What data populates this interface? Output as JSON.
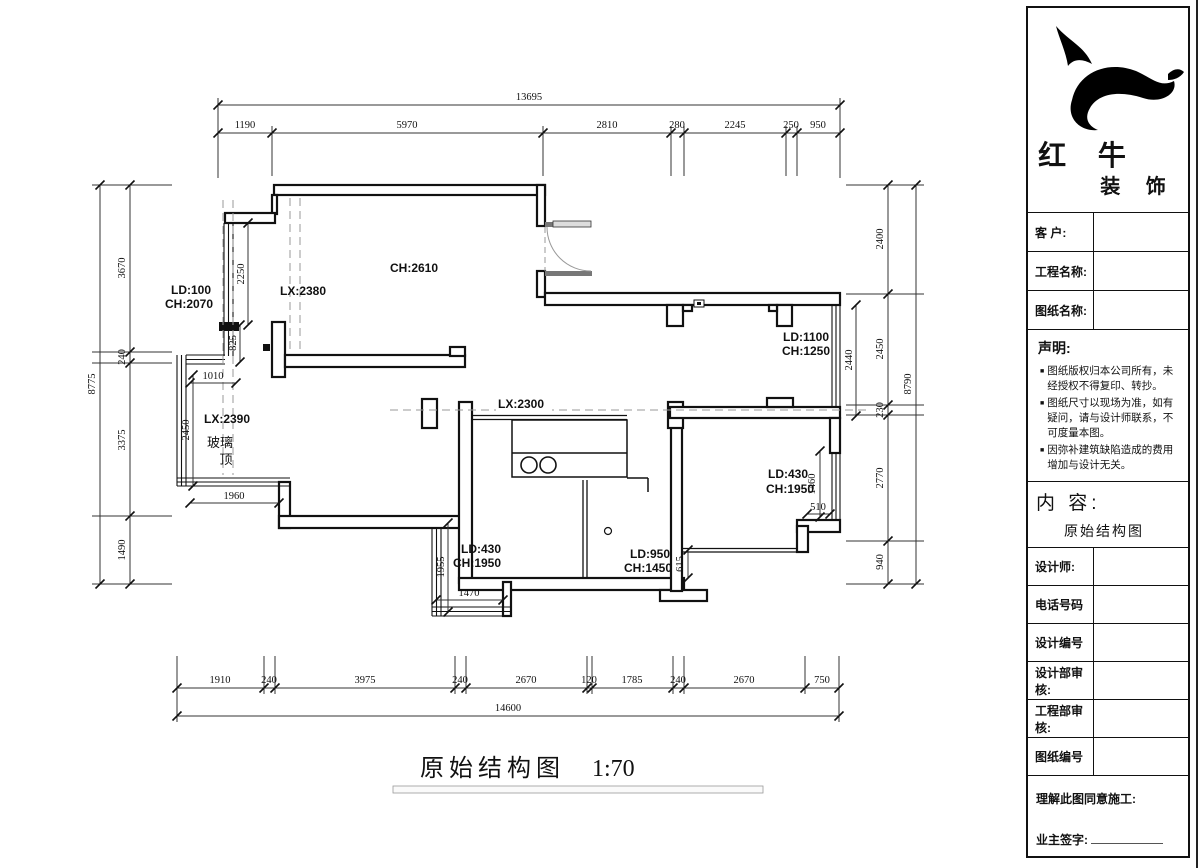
{
  "drawing": {
    "title": "原始结构图",
    "scale_text": "1:70",
    "dims": {
      "top_total": "13695",
      "top": [
        "1190",
        "5970",
        "2810",
        "280",
        "2245",
        "250",
        "950"
      ],
      "bottom_total": "14600",
      "bottom": [
        "1910",
        "240",
        "3975",
        "240",
        "2670",
        "120",
        "1785",
        "240",
        "2670",
        "750"
      ],
      "left_total": "8775",
      "left": [
        "3670",
        "240",
        "3375",
        "1490"
      ],
      "right_total": "8790",
      "right": [
        "2400",
        "2450",
        "230",
        "2770",
        "940"
      ],
      "inner": {
        "w2250": "2250",
        "w825": "825",
        "w1010": "1010",
        "w2450": "2450",
        "w1960": "1960",
        "w1955": "1955",
        "w1470": "1470",
        "w2440": "2440",
        "w1460": "1460",
        "w510": "510",
        "w615": "615"
      }
    },
    "labels": {
      "ld100": "LD:100",
      "ch2070": "CH:2070",
      "lx2380": "LX:2380",
      "ch2610": "CH:2610",
      "lx2390": "LX:2390",
      "glass1": "玻璃",
      "glass2": "顶",
      "lx2300": "LX:2300",
      "ld1100": "LD:1100",
      "ch1250": "CH:1250",
      "ld430_left": "LD:430",
      "ch1950_left": "CH:1950",
      "ld950": "LD:950",
      "ch1450": "CH:1450",
      "ld430_right": "LD:430",
      "ch1950_right": "CH:1950"
    }
  },
  "panel": {
    "brand": {
      "line1": "红 牛",
      "line2": "装 饰"
    },
    "info_rows": [
      {
        "label": "客  户:",
        "value": ""
      },
      {
        "label": "工程名称:",
        "value": ""
      },
      {
        "label": "图纸名称:",
        "value": ""
      }
    ],
    "statement": {
      "heading": "声明:",
      "items": [
        "图纸版权归本公司所有，未经授权不得复印、转抄。",
        "图纸尺寸以现场为准，如有疑问，请与设计师联系，不可度量本图。",
        "因弥补建筑缺陷造成的费用增加与设计无关。"
      ]
    },
    "content": {
      "heading": "内 容:",
      "value": "原始结构图"
    },
    "detail_rows": [
      {
        "label": "设计师:",
        "value": ""
      },
      {
        "label": "电话号码",
        "value": ""
      },
      {
        "label": "设计编号",
        "value": ""
      },
      {
        "label": "设计部审核:",
        "value": ""
      },
      {
        "label": "工程部审核:",
        "value": ""
      },
      {
        "label": "图纸编号",
        "value": ""
      }
    ],
    "footer": {
      "line1": "理解此图同意施工:",
      "line2": "业主签字:"
    }
  }
}
